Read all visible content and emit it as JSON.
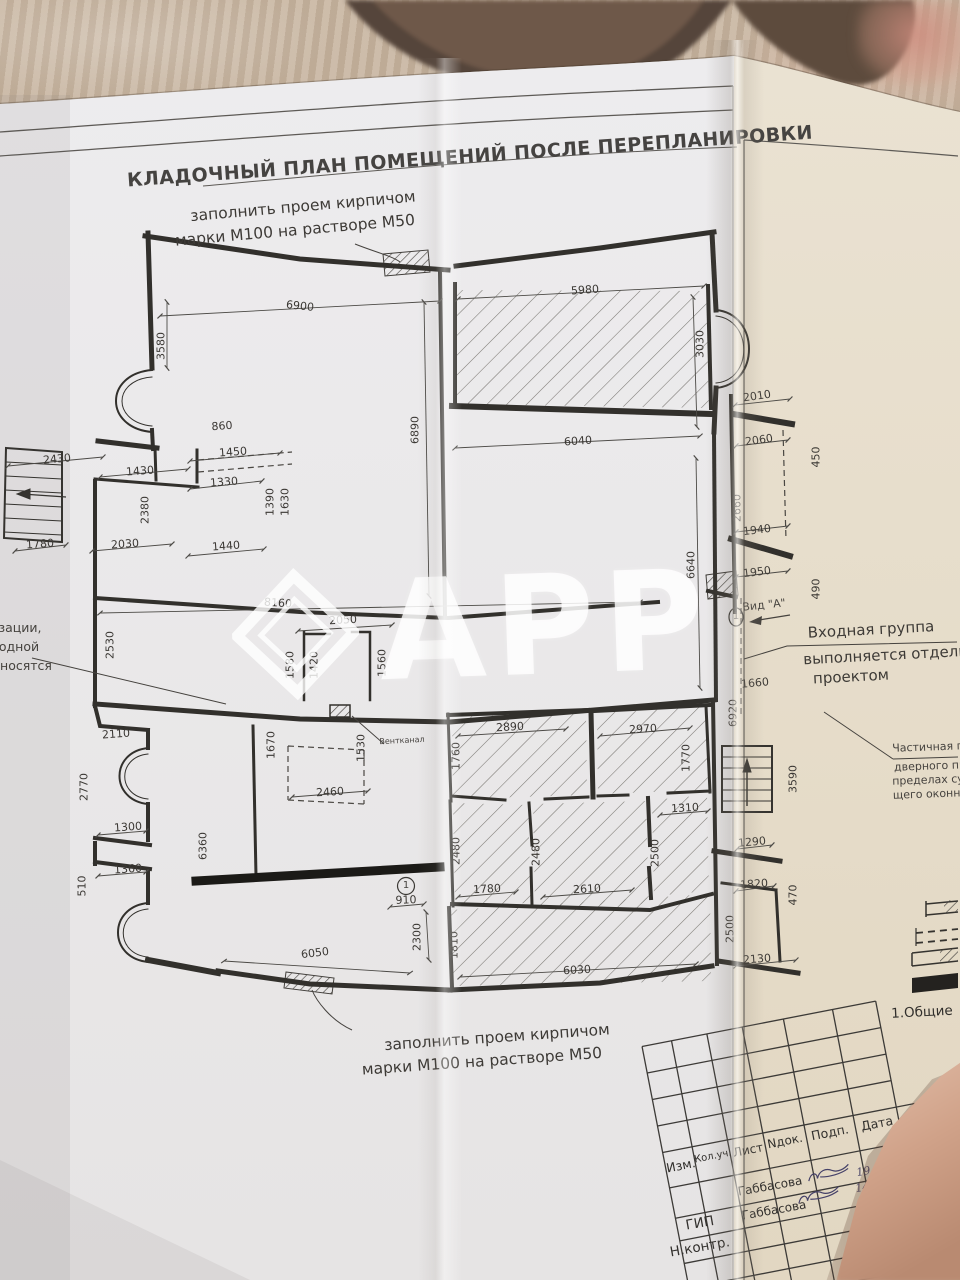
{
  "watermark": {
    "text": "АРР",
    "logo": "diamond-logo"
  },
  "drawing": {
    "title_block": {
      "cells": [
        {
          "n": "tb-header-izm",
          "t": "Изм.",
          "x": 681,
          "y": 1166,
          "r": -11,
          "s": 12.5,
          "c": "tbt"
        },
        {
          "n": "tb-header-koluch",
          "t": "Кол.уч.",
          "x": 713,
          "y": 1157,
          "r": -11,
          "s": 10,
          "c": "tbt"
        },
        {
          "n": "tb-header-list",
          "t": "Лист",
          "x": 748,
          "y": 1150,
          "r": -11,
          "s": 12,
          "c": "tbt"
        },
        {
          "n": "tb-header-ndok",
          "t": "Nдок.",
          "x": 785,
          "y": 1141,
          "r": -11,
          "s": 12,
          "c": "tbt"
        },
        {
          "n": "tb-header-podp",
          "t": "Подп.",
          "x": 830,
          "y": 1133,
          "r": -11,
          "s": 12.5,
          "c": "tbt"
        },
        {
          "n": "tb-header-data",
          "t": "Дата",
          "x": 877,
          "y": 1124,
          "r": -11,
          "s": 12.5,
          "c": "tbt"
        },
        {
          "n": "tb-name-row1",
          "t": "Габбасова",
          "x": 770,
          "y": 1186,
          "r": -10,
          "s": 12,
          "c": "tbt"
        },
        {
          "n": "tb-date-row1",
          "t": "19.21",
          "x": 872,
          "y": 1170,
          "r": -10,
          "s": 11,
          "c": "hand"
        },
        {
          "n": "tb-role-gip",
          "t": "ГИП",
          "x": 700,
          "y": 1224,
          "r": -10,
          "s": 13.5,
          "c": "tbt"
        },
        {
          "n": "tb-name-row2",
          "t": "Габбасова",
          "x": 774,
          "y": 1210,
          "r": -10,
          "s": 12,
          "c": "tbt"
        },
        {
          "n": "tb-date-row2",
          "t": "14.21",
          "x": 871,
          "y": 1186,
          "r": -10,
          "s": 11,
          "c": "hand"
        },
        {
          "n": "tb-role-nkontr",
          "t": "Н.контр.",
          "x": 700,
          "y": 1248,
          "r": -10,
          "s": 13.5,
          "c": "tbt"
        },
        {
          "n": "tb-project-line1",
          "t": "Перепла",
          "x": 920,
          "y": 1147,
          "r": -9,
          "s": 14.5,
          "c": "tbt"
        },
        {
          "n": "tb-project-line2",
          "t": "щения п",
          "x": 923,
          "y": 1168,
          "r": -9,
          "s": 14.5,
          "c": "tbt"
        },
        {
          "n": "tb-project-line3",
          "t": "ул.Беке",
          "x": 926,
          "y": 1189,
          "r": -9,
          "s": 14.5,
          "c": "tbt"
        },
        {
          "n": "tb-sheet-title-line1",
          "t": "Кладоч",
          "x": 928,
          "y": 1232,
          "r": -9,
          "s": 13.5,
          "c": "tbt"
        },
        {
          "n": "tb-sheet-title-line2",
          "t": "после",
          "x": 936,
          "y": 1255,
          "r": -9,
          "s": 13.5,
          "c": "tbt"
        }
      ]
    },
    "texts": [
      {
        "n": "drawing-title",
        "t": "КЛАДОЧНЫЙ  ПЛАН ПОМЕЩЕНИЙ ПОСЛЕ ПЕРЕПЛАНИРОВКИ",
        "x": 470,
        "y": 157,
        "r": -4,
        "s": 19,
        "c": "ttl"
      },
      {
        "n": "note-top-line1",
        "t": "заполнить проем кирпичом",
        "x": 303,
        "y": 207,
        "r": -5,
        "s": 15.5,
        "c": "note"
      },
      {
        "n": "note-top-line2",
        "t": "марки М100 на растворе М50",
        "x": 295,
        "y": 231,
        "r": -5,
        "s": 15.5,
        "c": "note"
      },
      {
        "n": "note-bottom-line1",
        "t": "заполнить проем кирпичом",
        "x": 497,
        "y": 1038,
        "r": -4,
        "s": 15.5,
        "c": "note"
      },
      {
        "n": "note-bottom-line2",
        "t": "марки М100 на растворе М50",
        "x": 482,
        "y": 1062,
        "r": -4,
        "s": 15.5,
        "c": "note"
      },
      {
        "n": "view-a-label",
        "t": "Вид \"А\"",
        "x": 764,
        "y": 605,
        "r": -6,
        "s": 11,
        "c": "sm"
      },
      {
        "n": "view-a-marker",
        "t": "1",
        "x": 736,
        "y": 617,
        "r": 0,
        "s": 10,
        "c": "sm"
      },
      {
        "n": "entrance-note-line1",
        "t": "Входная группа",
        "x": 871,
        "y": 630,
        "r": -3,
        "s": 15,
        "c": "note"
      },
      {
        "n": "entrance-note-line2",
        "t": "выполняется отдельны",
        "x": 896,
        "y": 655,
        "r": -3,
        "s": 15,
        "c": "note"
      },
      {
        "n": "entrance-note-line3",
        "t": "проектом",
        "x": 851,
        "y": 677,
        "r": -3,
        "s": 15,
        "c": "note"
      },
      {
        "n": "partial-note-line1",
        "t": "Частичная п",
        "x": 928,
        "y": 747,
        "r": -2,
        "s": 11,
        "c": "sm"
      },
      {
        "n": "partial-note-line2",
        "t": "дверного пр",
        "x": 930,
        "y": 766,
        "r": -2,
        "s": 11,
        "c": "sm"
      },
      {
        "n": "partial-note-line3",
        "t": "пределах су",
        "x": 928,
        "y": 780,
        "r": -2,
        "s": 11,
        "c": "sm"
      },
      {
        "n": "partial-note-line4",
        "t": "щего оконно",
        "x": 930,
        "y": 794,
        "r": -2,
        "s": 11,
        "c": "sm"
      },
      {
        "n": "left-cut-note-line1",
        "t": "зации,",
        "x": 20,
        "y": 628,
        "r": 0,
        "s": 12.5,
        "c": "sm"
      },
      {
        "n": "left-cut-note-line2",
        "t": "одной",
        "x": 19,
        "y": 647,
        "r": 0,
        "s": 12.5,
        "c": "sm"
      },
      {
        "n": "left-cut-note-line3",
        "t": "носятся",
        "x": 26,
        "y": 666,
        "r": 0,
        "s": 12.5,
        "c": "sm"
      },
      {
        "n": "vent-duct-label",
        "t": "Вентканал",
        "x": 402,
        "y": 741,
        "r": -3,
        "s": 8,
        "c": "sm"
      },
      {
        "n": "axis-marker-1",
        "t": "1",
        "x": 406,
        "y": 886,
        "r": 0,
        "s": 10,
        "c": "sm"
      },
      {
        "n": "general-notes-heading",
        "t": "1.Общие",
        "x": 922,
        "y": 1013,
        "r": -3,
        "s": 13.5,
        "c": "tbt"
      }
    ],
    "dimensions": [
      {
        "v": "6900",
        "x": 300,
        "y": 306,
        "r": 6
      },
      {
        "v": "5980",
        "x": 585,
        "y": 290,
        "r": -4
      },
      {
        "v": "3030",
        "x": 700,
        "y": 344,
        "r": -90
      },
      {
        "v": "3580",
        "x": 161,
        "y": 346,
        "r": -90
      },
      {
        "v": "2430",
        "x": 57,
        "y": 459,
        "r": -5
      },
      {
        "v": "860",
        "x": 222,
        "y": 426,
        "r": -4
      },
      {
        "v": "1450",
        "x": 233,
        "y": 452,
        "r": -4
      },
      {
        "v": "1430",
        "x": 140,
        "y": 471,
        "r": -4
      },
      {
        "v": "1330",
        "x": 224,
        "y": 482,
        "r": -4
      },
      {
        "v": "1390",
        "x": 270,
        "y": 502,
        "r": -90
      },
      {
        "v": "1630",
        "x": 285,
        "y": 502,
        "r": -90
      },
      {
        "v": "2380",
        "x": 145,
        "y": 510,
        "r": -90
      },
      {
        "v": "1440",
        "x": 226,
        "y": 546,
        "r": -4
      },
      {
        "v": "2030",
        "x": 125,
        "y": 544,
        "r": -4
      },
      {
        "v": "1780",
        "x": 40,
        "y": 544,
        "r": -4
      },
      {
        "v": "6890",
        "x": 415,
        "y": 430,
        "r": -90
      },
      {
        "v": "6040",
        "x": 578,
        "y": 441,
        "r": -4
      },
      {
        "v": "6640",
        "x": 691,
        "y": 565,
        "r": -90
      },
      {
        "v": "2010",
        "x": 757,
        "y": 396,
        "r": -8
      },
      {
        "v": "2060",
        "x": 759,
        "y": 440,
        "r": -8
      },
      {
        "v": "450",
        "x": 816,
        "y": 457,
        "r": -90
      },
      {
        "v": "2660",
        "x": 737,
        "y": 508,
        "r": -90
      },
      {
        "v": "1940",
        "x": 757,
        "y": 530,
        "r": -7
      },
      {
        "v": "1950",
        "x": 757,
        "y": 572,
        "r": -7
      },
      {
        "v": "490",
        "x": 816,
        "y": 589,
        "r": -90
      },
      {
        "v": "1660",
        "x": 755,
        "y": 683,
        "r": -5
      },
      {
        "v": "6920",
        "x": 733,
        "y": 713,
        "r": -90
      },
      {
        "v": "8160",
        "x": 278,
        "y": 603,
        "r": 4
      },
      {
        "v": "2530",
        "x": 110,
        "y": 645,
        "r": -90
      },
      {
        "v": "2050",
        "x": 343,
        "y": 620,
        "r": -3
      },
      {
        "v": "1580",
        "x": 290,
        "y": 665,
        "r": -90
      },
      {
        "v": "1420",
        "x": 314,
        "y": 665,
        "r": -90
      },
      {
        "v": "1560",
        "x": 382,
        "y": 663,
        "r": -90
      },
      {
        "v": "2110",
        "x": 116,
        "y": 734,
        "r": -4
      },
      {
        "v": "2770",
        "x": 84,
        "y": 787,
        "r": -90
      },
      {
        "v": "1670",
        "x": 271,
        "y": 745,
        "r": -90
      },
      {
        "v": "1530",
        "x": 361,
        "y": 748,
        "r": -90
      },
      {
        "v": "2460",
        "x": 330,
        "y": 792,
        "r": -3
      },
      {
        "v": "2890",
        "x": 510,
        "y": 727,
        "r": -3
      },
      {
        "v": "2970",
        "x": 643,
        "y": 729,
        "r": -3
      },
      {
        "v": "1760",
        "x": 456,
        "y": 756,
        "r": -90
      },
      {
        "v": "1770",
        "x": 686,
        "y": 758,
        "r": -90
      },
      {
        "v": "1310",
        "x": 685,
        "y": 808,
        "r": -3
      },
      {
        "v": "2480",
        "x": 456,
        "y": 851,
        "r": -90
      },
      {
        "v": "2480",
        "x": 536,
        "y": 852,
        "r": -90
      },
      {
        "v": "2500",
        "x": 655,
        "y": 853,
        "r": -90
      },
      {
        "v": "1780",
        "x": 487,
        "y": 889,
        "r": -3
      },
      {
        "v": "2610",
        "x": 587,
        "y": 889,
        "r": -3
      },
      {
        "v": "910",
        "x": 406,
        "y": 900,
        "r": -2
      },
      {
        "v": "2300",
        "x": 417,
        "y": 937,
        "r": -90
      },
      {
        "v": "1810",
        "x": 454,
        "y": 945,
        "r": -90
      },
      {
        "v": "6030",
        "x": 577,
        "y": 970,
        "r": -3
      },
      {
        "v": "6050",
        "x": 315,
        "y": 953,
        "r": -7
      },
      {
        "v": "1300",
        "x": 128,
        "y": 827,
        "r": -4
      },
      {
        "v": "1360",
        "x": 128,
        "y": 869,
        "r": -4
      },
      {
        "v": "510",
        "x": 82,
        "y": 886,
        "r": -90
      },
      {
        "v": "6360",
        "x": 203,
        "y": 846,
        "r": -90
      },
      {
        "v": "1290",
        "x": 752,
        "y": 842,
        "r": -5
      },
      {
        "v": "1820",
        "x": 754,
        "y": 884,
        "r": -4
      },
      {
        "v": "470",
        "x": 793,
        "y": 895,
        "r": -90
      },
      {
        "v": "2500",
        "x": 730,
        "y": 929,
        "r": -90
      },
      {
        "v": "2130",
        "x": 757,
        "y": 959,
        "r": -4
      },
      {
        "v": "3590",
        "x": 793,
        "y": 779,
        "r": -90
      }
    ]
  }
}
